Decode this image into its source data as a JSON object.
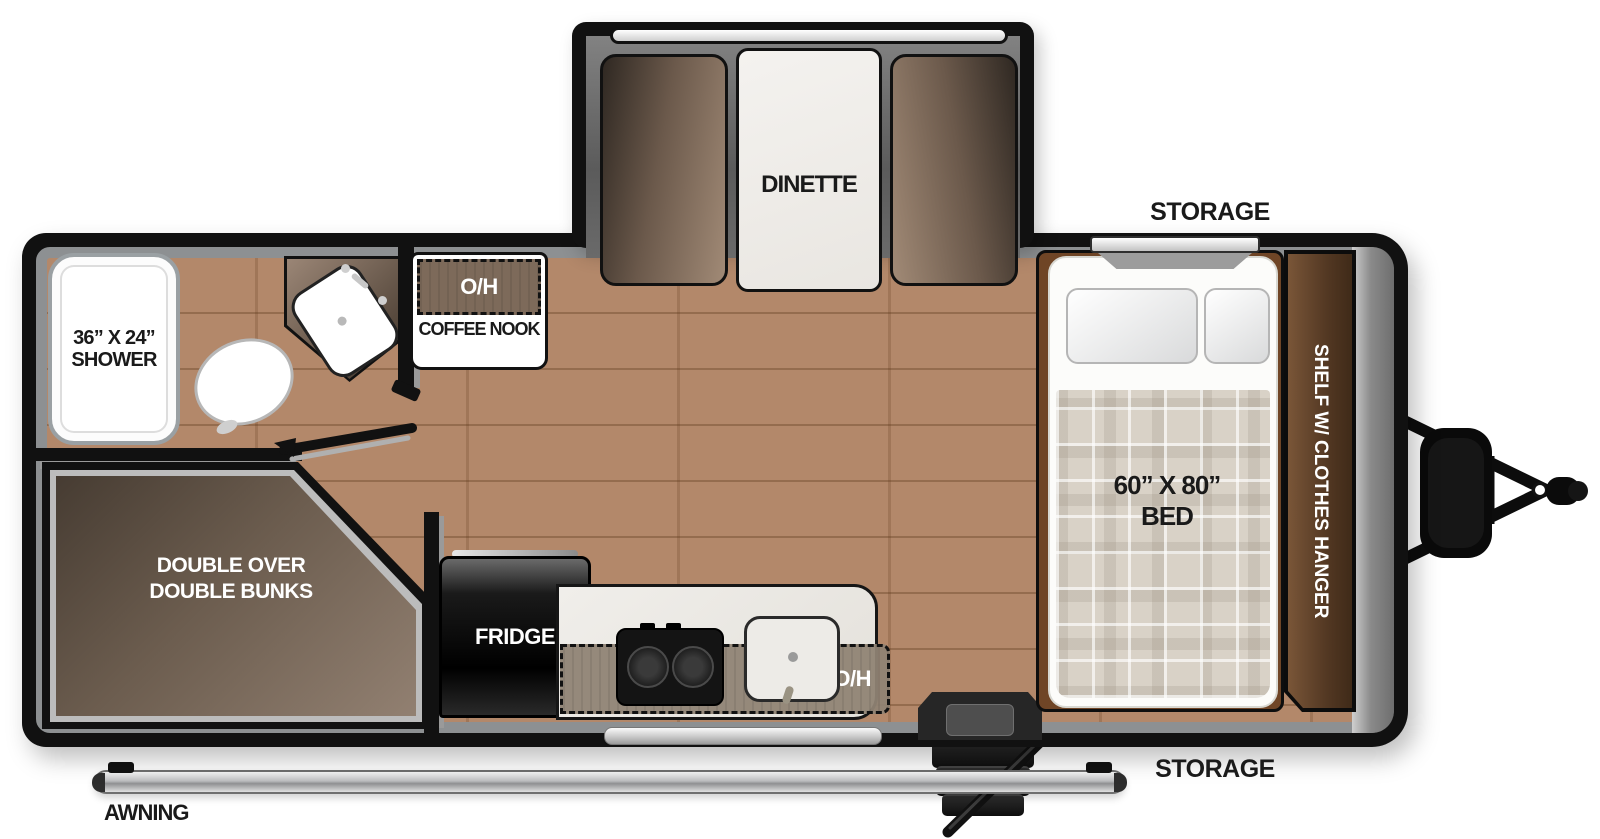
{
  "labels": {
    "dinette": "DINETTE",
    "storage_top": "STORAGE",
    "storage_bottom": "STORAGE",
    "shower_line1": "36” X 24”",
    "shower_line2": "SHOWER",
    "coffee_nook_oh": "O/H",
    "coffee_nook": "COFFEE NOOK",
    "bunks_line1": "DOUBLE OVER",
    "bunks_line2": "DOUBLE BUNKS",
    "fridge": "FRIDGE",
    "kitchen_oh": "O/H",
    "bed_line1": "60” X 80”",
    "bed_line2": "BED",
    "shelf": "SHELF W/ CLOTHES HANGER",
    "awning": "AWNING"
  },
  "colors": {
    "wall": "#111111",
    "floor_wood": "#b3886a",
    "interior_trim": "#8d9092",
    "bench_brown": "#6b594b",
    "bunk_brown": "#6b5c4e",
    "shelf_brown": "#533823",
    "overhead_brown": "#7d6a5a",
    "counter_marble": "#eeebe6",
    "counter_wood": "#8f8374",
    "blanket_plaid": "#d9d2c7",
    "fridge_black": "#111111",
    "awning_silver": "#c9cacc"
  }
}
